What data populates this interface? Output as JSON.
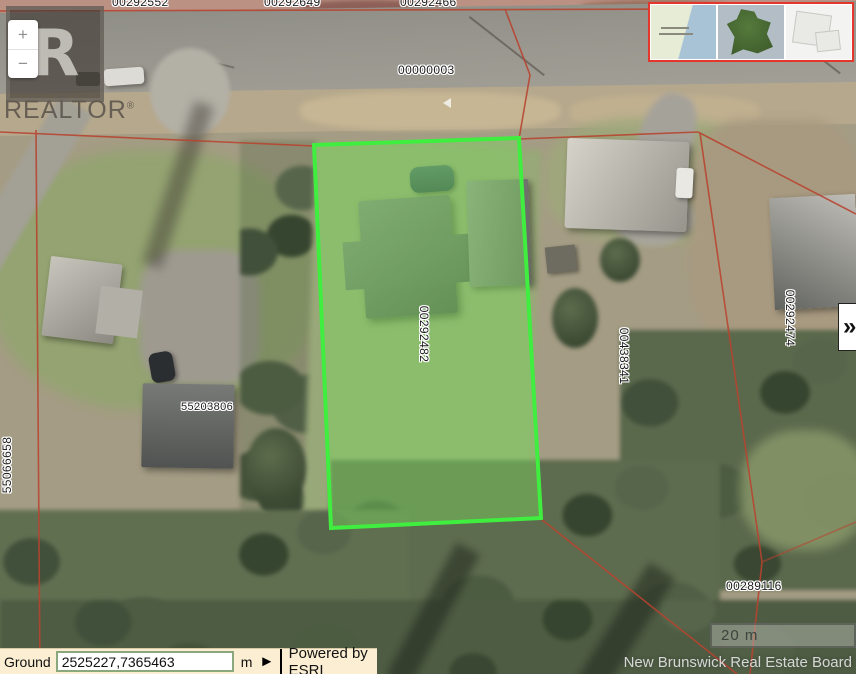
{
  "map": {
    "parcel_labels": [
      {
        "text": "00292552"
      },
      {
        "text": "00292649"
      },
      {
        "text": "00292466"
      },
      {
        "text": "00000003"
      },
      {
        "text": "00292482"
      },
      {
        "text": "00438341"
      },
      {
        "text": "00292474"
      },
      {
        "text": "55203806"
      },
      {
        "text": "00289116"
      },
      {
        "text": "55066658"
      }
    ],
    "highlighted_parcel_id": "00292482",
    "scale_bar": {
      "label": "20 m"
    },
    "attribution": "New Brunswick Real Estate Board",
    "colors": {
      "highlight_green": "#3fee3f",
      "highlight_fill": "rgba(125,215,95,0.45)",
      "boundary_red": "#b8432f",
      "inset_border_red": "#e3362c",
      "toolbar_bg": "#fbeed2"
    }
  },
  "watermark": {
    "initial": "R",
    "name": "REALTOR",
    "registered": "®"
  },
  "controls": {
    "zoom_in": "+",
    "zoom_out": "−",
    "expand": "»"
  },
  "toolbar": {
    "coordinate_label": "Ground",
    "coordinate_value": "2525227,7365463",
    "unit": "m",
    "go_button": "►",
    "powered_by": "Powered by ESRI"
  }
}
